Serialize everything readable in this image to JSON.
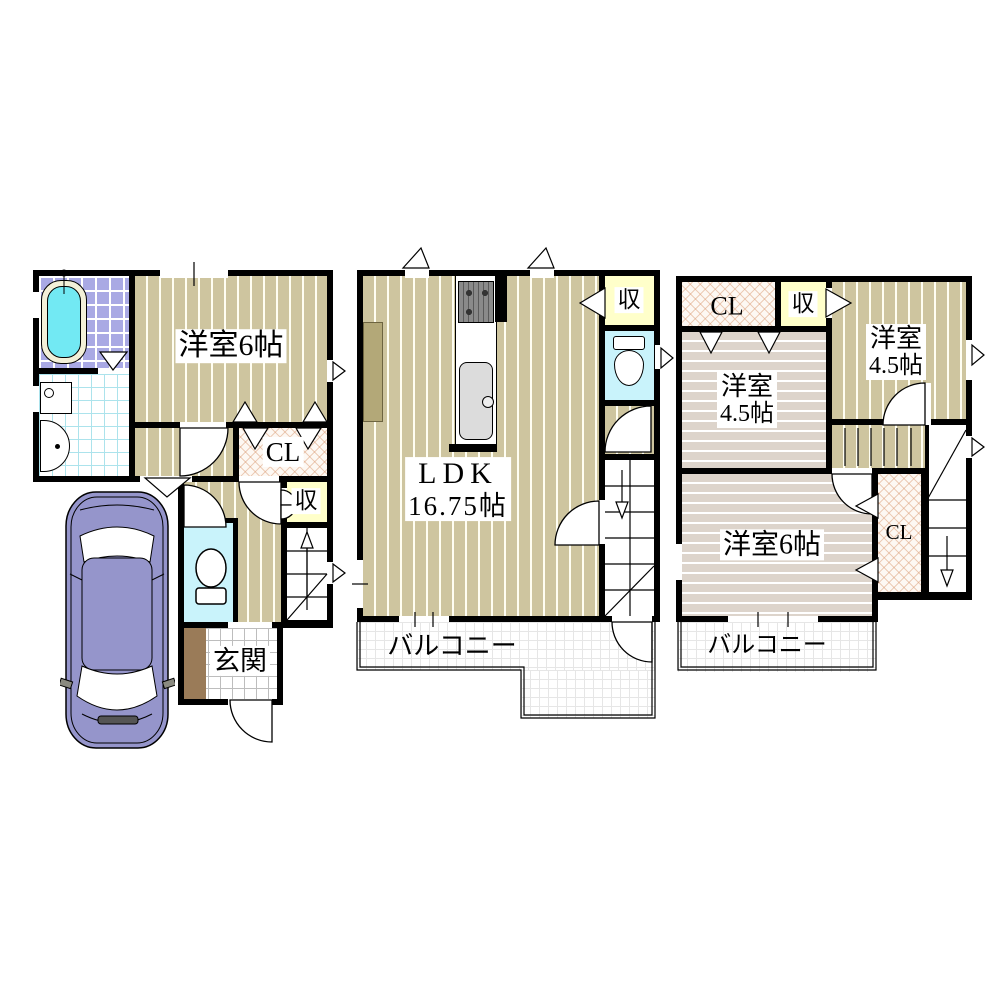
{
  "floor1": {
    "room6_label": "洋室6帖",
    "closet_label": "CL",
    "storage_label": "収",
    "entrance_label": "玄関"
  },
  "floor2": {
    "ldk_label": "LDK",
    "ldk_size_label": "16.75帖",
    "storage_label": "収",
    "balcony_label": "バルコニー"
  },
  "floor3": {
    "closet_top_label": "CL",
    "storage_label": "収",
    "room_a_label": "洋室",
    "room_a_size_label": "4.5帖",
    "room_b_label": "洋室",
    "room_b_size_label": "4.5帖",
    "room6_label": "洋室6帖",
    "closet_bottom_label": "CL",
    "balcony_label": "バルコニー"
  },
  "palette": {
    "wall": "#000000",
    "wood_floor": "#cec59f",
    "pink_floor": "#ddd4cb",
    "storage_yellow": "#ffffca",
    "toilet_cyan": "#c9f3fb",
    "bath_tile_purple": "#a9a9e4",
    "wash_tile_cyan": "#ace3ec",
    "entrance_brown": "#9a7b58",
    "car_body_purple": "#9595cb",
    "bathtub_cyan": "#72e9f3",
    "closet_hatch": "#d89670",
    "kitchen_counter_tan": "#b3a878"
  }
}
